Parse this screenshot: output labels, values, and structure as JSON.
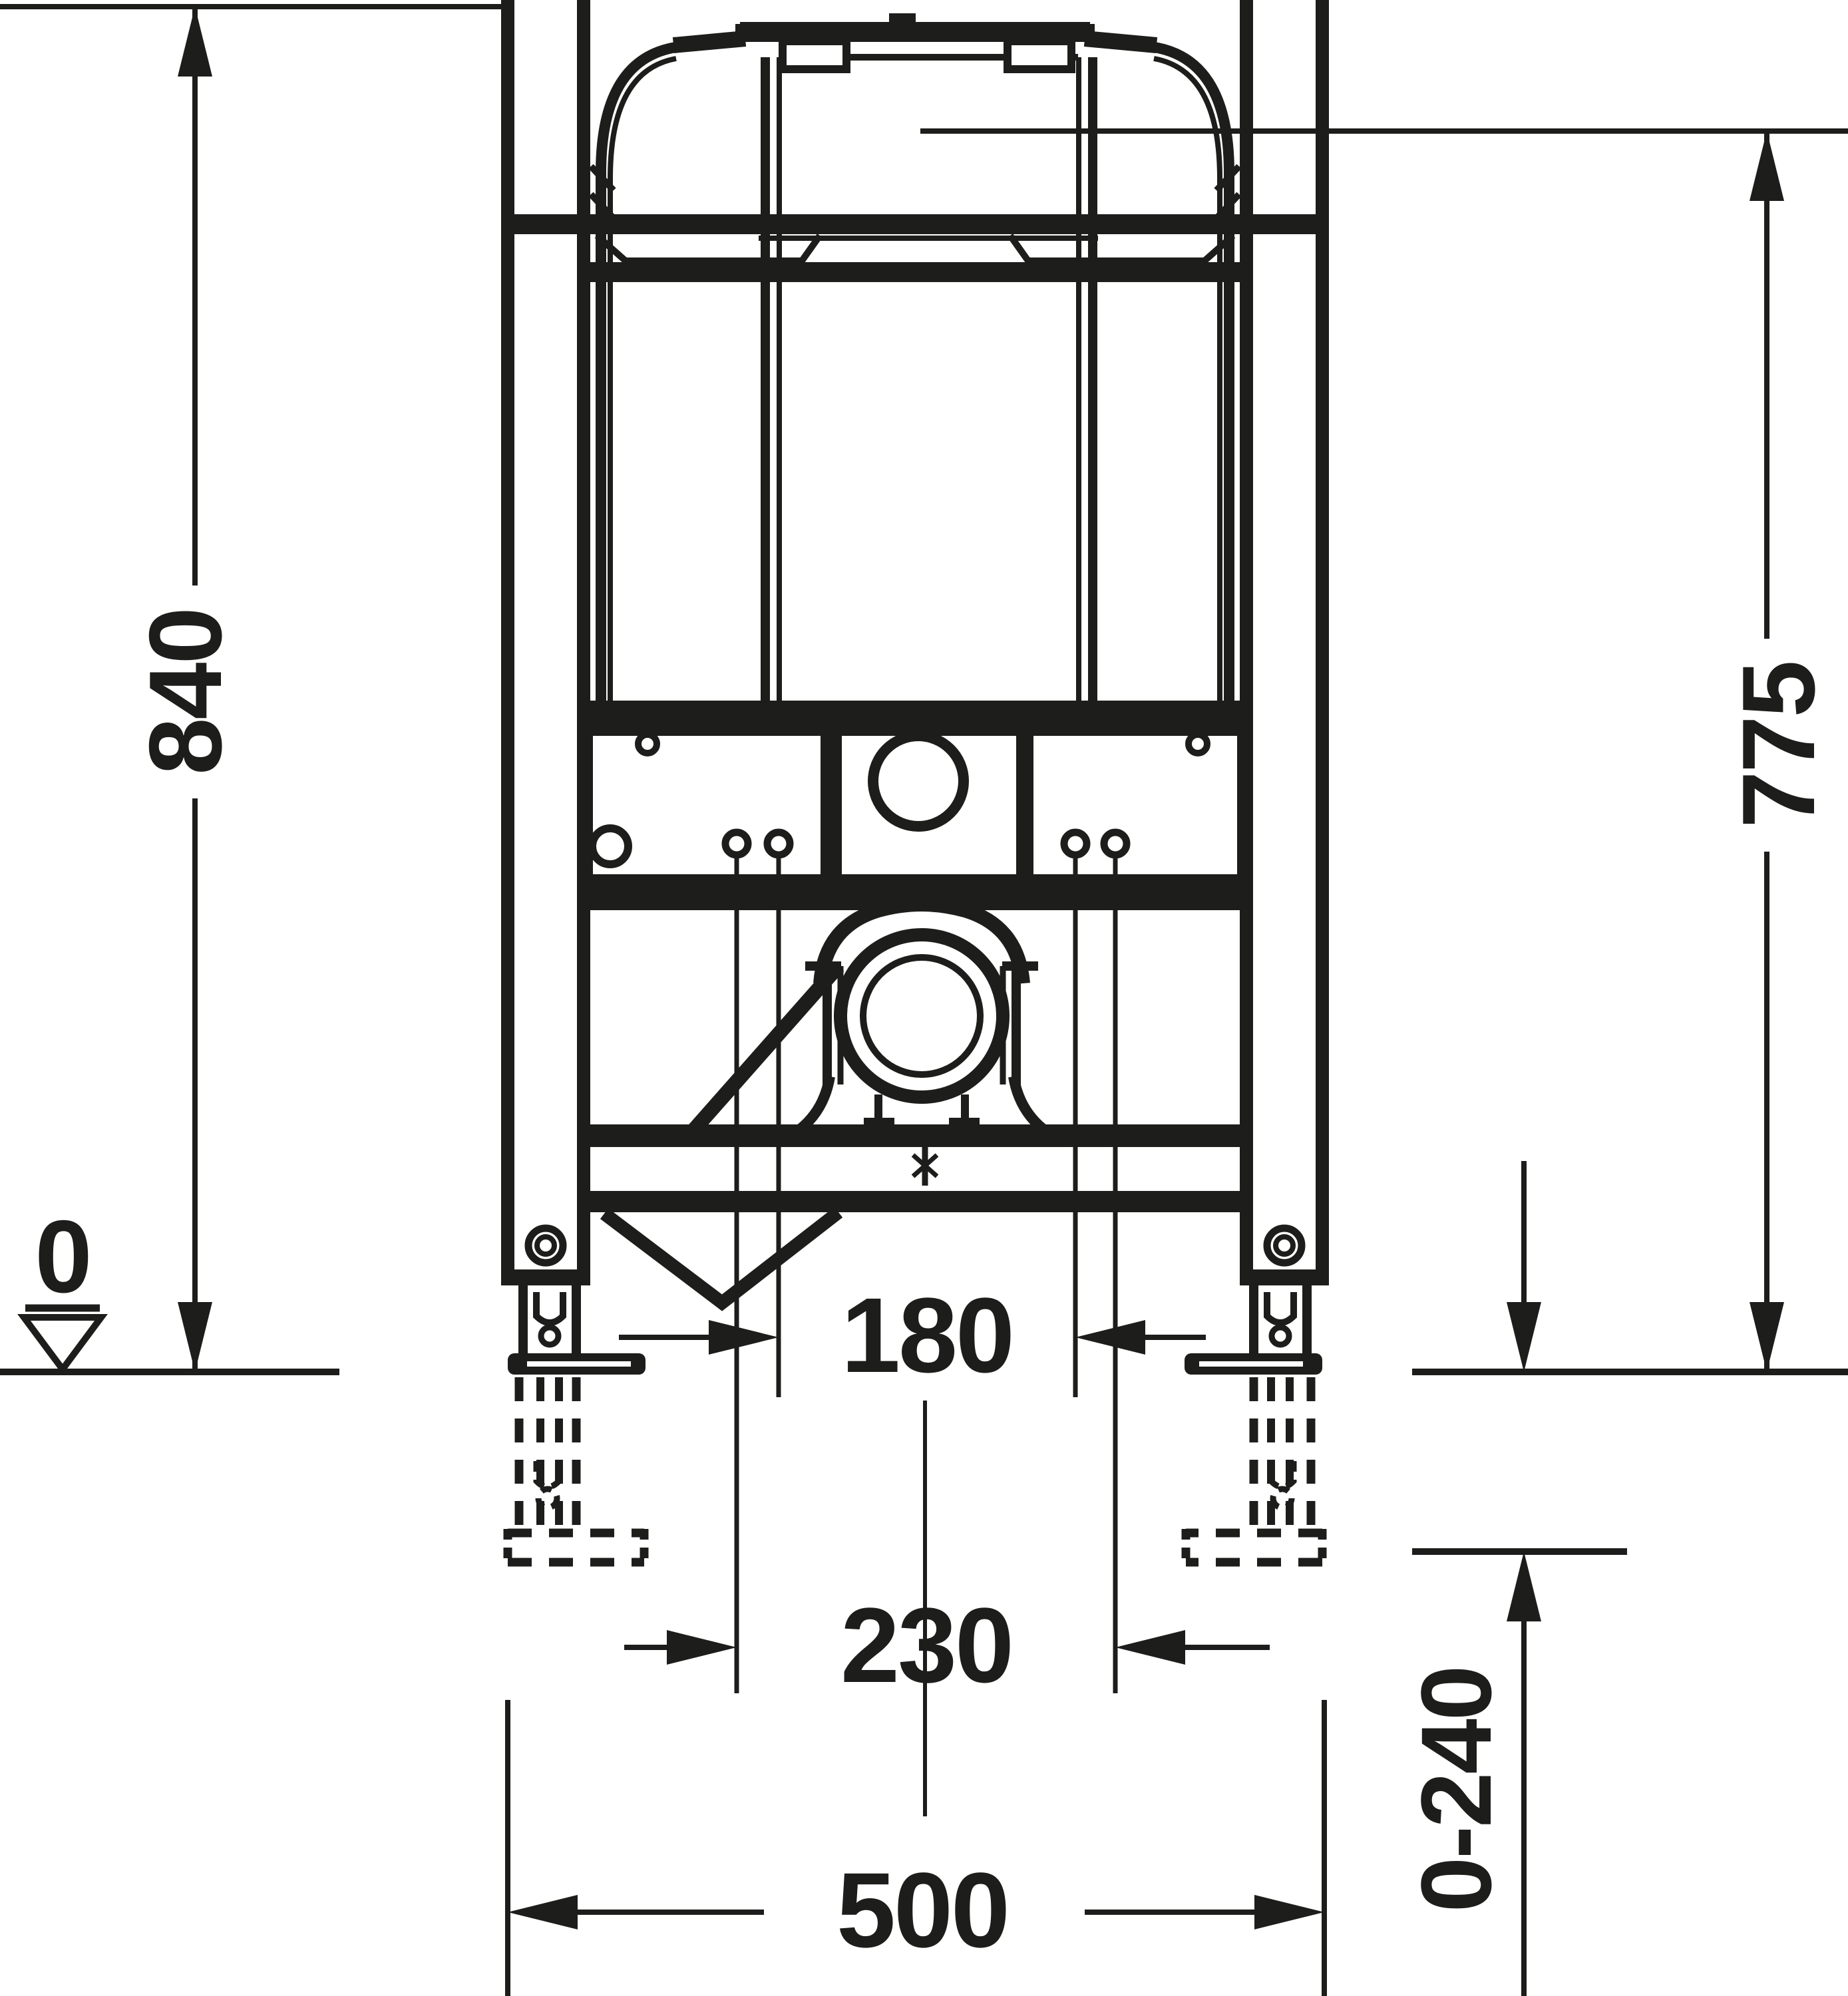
{
  "drawing": {
    "type": "technical-dimension-drawing",
    "subject": "Concealed WC cistern installation frame, front elevation",
    "units": "mm",
    "ink_color": "#1d1d1b",
    "background_color": "#ffffff"
  },
  "dims": {
    "h840": {
      "label": "840",
      "orientation": "vertical-left",
      "meaning": "height from floor datum to top reference of frame"
    },
    "h775": {
      "label": "775",
      "orientation": "vertical-right",
      "meaning": "height from floor datum to cistern reference line"
    },
    "w180": {
      "label": "180",
      "orientation": "horizontal",
      "meaning": "distance between inner fixing bolts"
    },
    "w230": {
      "label": "230",
      "orientation": "horizontal",
      "meaning": "distance between outer fixing bolts"
    },
    "w500": {
      "label": "500",
      "orientation": "horizontal",
      "meaning": "overall frame width"
    },
    "adj": {
      "label": "0-240",
      "orientation": "vertical-right",
      "meaning": "adjustable foot extension range"
    },
    "datum": {
      "label": "0",
      "orientation": "datum",
      "meaning": "finished floor level"
    }
  }
}
